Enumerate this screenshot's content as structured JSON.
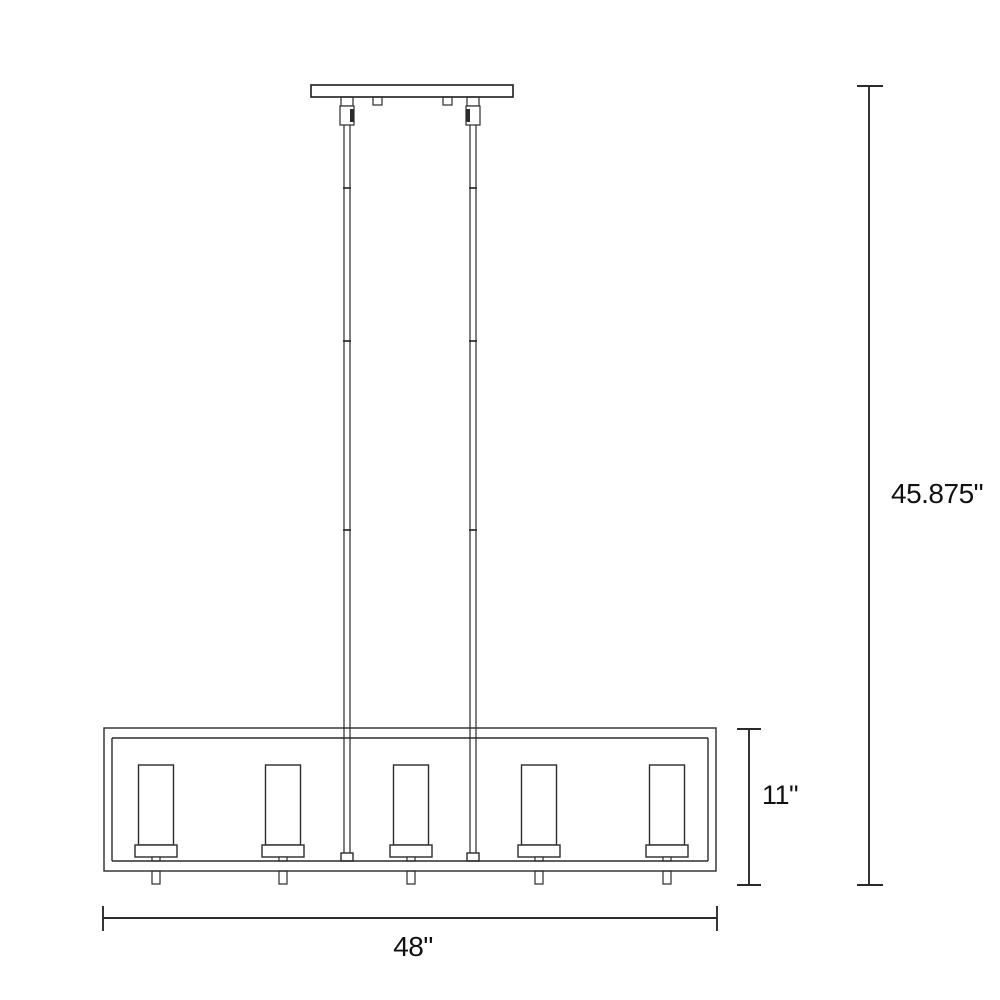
{
  "diagram": {
    "subject": "linear-chandelier-dimension-drawing",
    "background_color": "#ffffff",
    "line_color": "#2b2b2b",
    "label_color": "#111111",
    "shade_count": 5,
    "rod_count": 2,
    "rod_joint_count": 3,
    "dimensions": {
      "overall_height": "45.875\"",
      "body_height": "11\"",
      "width": "48\""
    }
  }
}
